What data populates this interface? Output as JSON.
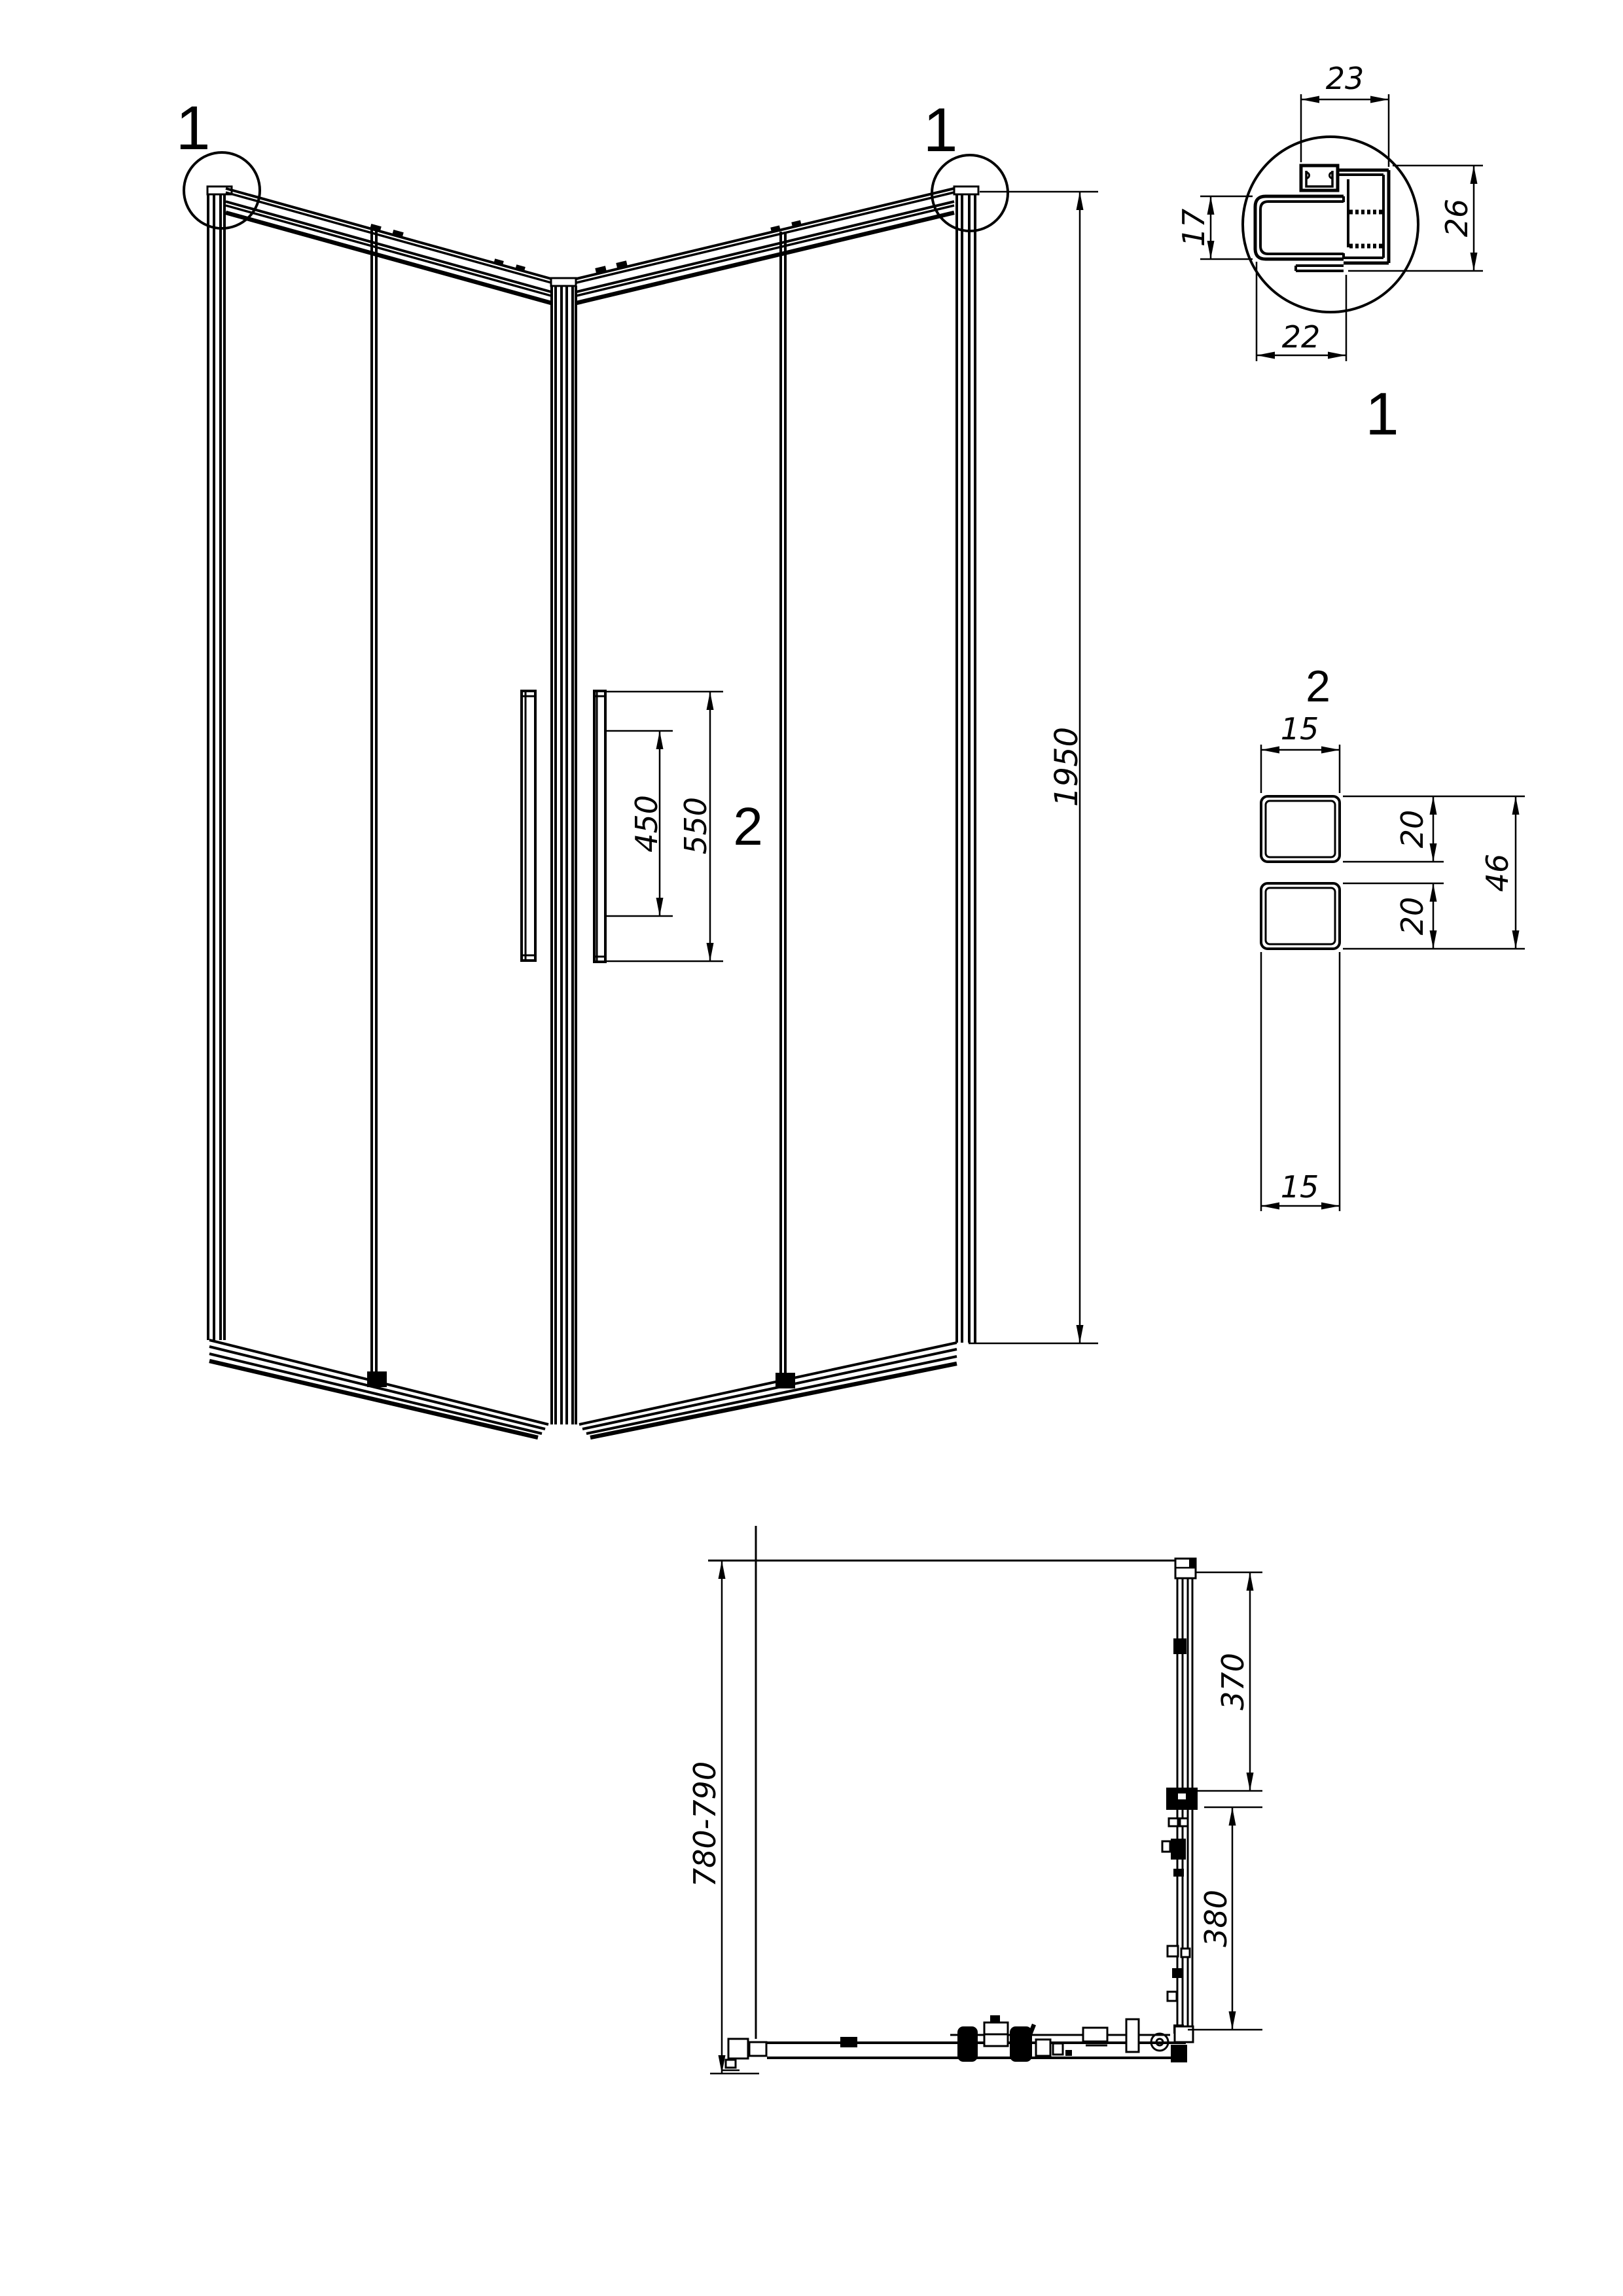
{
  "front_view": {
    "marker_left": "1",
    "marker_right": "1",
    "handle_ref": "2",
    "dim_height": "1950",
    "dim_handle_inner": "450",
    "dim_handle_outer": "550"
  },
  "detail1": {
    "label": "1",
    "dim_top": "23",
    "dim_right": "26",
    "dim_left": "17",
    "dim_bottom": "22"
  },
  "detail2": {
    "label": "2",
    "dim_width_top": "15",
    "dim_height_upper": "20",
    "dim_height_total": "46",
    "dim_height_lower": "20",
    "dim_width_bottom": "15"
  },
  "plan_view": {
    "dim_depth": "780-790",
    "dim_door": "370",
    "dim_fixed": "380"
  },
  "colors": {
    "line": "#000000",
    "background": "#ffffff"
  }
}
